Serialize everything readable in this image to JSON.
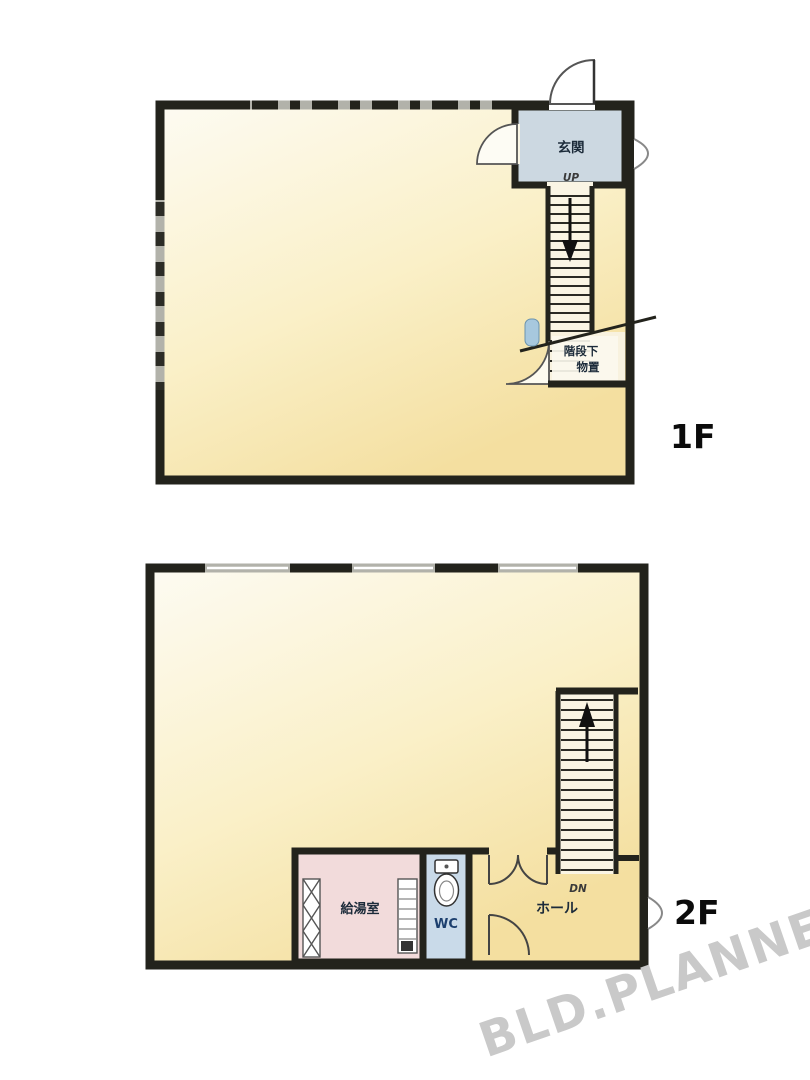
{
  "plan_1f": {
    "floor_label": "1F",
    "entrance_label": "玄関",
    "up_label": "UP",
    "understairs_storage_line1": "階段下",
    "understairs_storage_line2": "物置"
  },
  "plan_2f": {
    "floor_label": "2F",
    "kitchenette_label": "給湯室",
    "wc_label": "WC",
    "hall_label": "ホール",
    "down_label": "DN"
  },
  "watermark": {
    "text": "BLD.PLANNER",
    "color": "#c9c9c9"
  },
  "colors": {
    "wall": "#23231c",
    "room_cream_light": "#fdfbf2",
    "room_cream_deep": "#f4dfa0",
    "entrance_blue_gray": "#ccd8e1",
    "kitchenette_pink": "#f2dbdb",
    "wc_blue": "#c9dae9",
    "window_gray": "#b2b2aa",
    "fixture_blue": "#a7c8de"
  }
}
